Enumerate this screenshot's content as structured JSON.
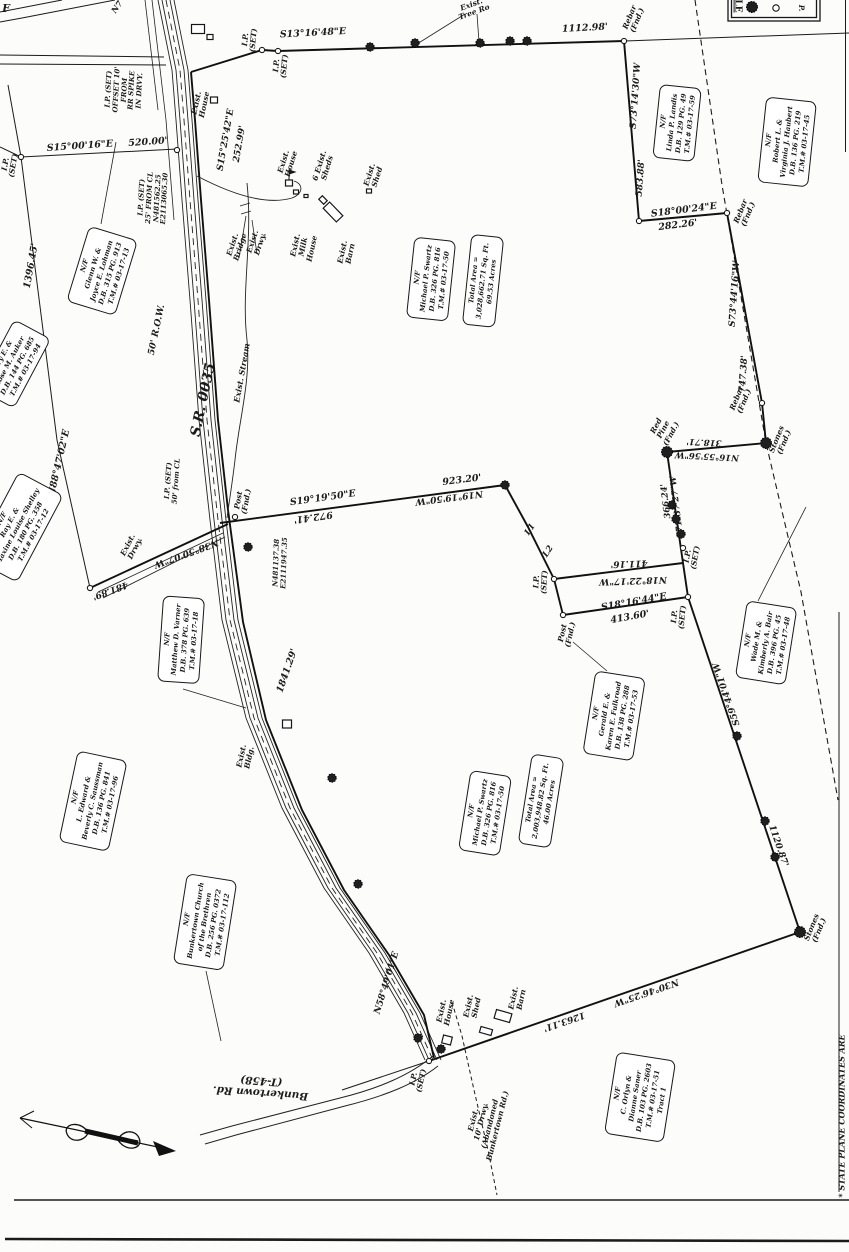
{
  "drawing": {
    "type": "land survey plat",
    "ink_color": "#1b1b1b",
    "paper_color": "#fcfcfa"
  },
  "legend": {
    "title_partial": "LE",
    "symbols": [
      "tree-symbol",
      "monument-circle",
      "pin-letter"
    ]
  },
  "labels": [
    {
      "id": "f_partial",
      "lines": [
        "F"
      ]
    },
    {
      "id": "n7_partial",
      "lines": [
        "N7"
      ]
    },
    {
      "id": "treerow",
      "lines": [
        "Exist.",
        "Tree Ro"
      ]
    },
    {
      "id": "b_s13",
      "lines": [
        "S13°16'48\"E"
      ]
    },
    {
      "id": "d_1112",
      "lines": [
        "1112.98'"
      ]
    },
    {
      "id": "rebar_top",
      "lines": [
        "Rebar",
        "(Fnd.)"
      ]
    },
    {
      "id": "b_s73_14",
      "lines": [
        "S73°14'30\"W"
      ]
    },
    {
      "id": "d_583",
      "lines": [
        "583.88'"
      ]
    },
    {
      "id": "b_s18_00",
      "lines": [
        "S18°00'24\"E"
      ]
    },
    {
      "id": "d_282",
      "lines": [
        "282.26'"
      ]
    },
    {
      "id": "rebar_2",
      "lines": [
        "Rebar",
        "(Fnd.)"
      ]
    },
    {
      "id": "b_s73_44",
      "lines": [
        "S73°44'16\"W"
      ]
    },
    {
      "id": "d_747",
      "lines": [
        "747.38'"
      ]
    },
    {
      "id": "rebar_3",
      "lines": [
        "Rebar",
        "(Fnd.)"
      ]
    },
    {
      "id": "stones_1",
      "lines": [
        "Stones",
        "(Fnd.)"
      ]
    },
    {
      "id": "redpine",
      "lines": [
        "Red",
        "Pine",
        "(Fnd.)"
      ]
    },
    {
      "id": "b_n16",
      "lines": [
        "N16°55'56\"W"
      ]
    },
    {
      "id": "d_318",
      "lines": [
        "318.71'"
      ]
    },
    {
      "id": "b_s71",
      "lines": [
        "S71°37'27\"W"
      ]
    },
    {
      "id": "d_366",
      "lines": [
        "366.24'"
      ]
    },
    {
      "id": "ip_set_r",
      "lines": [
        "I.P.",
        "(SET)"
      ]
    },
    {
      "id": "b_s19",
      "lines": [
        "S19°19'50\"E"
      ]
    },
    {
      "id": "d_972",
      "lines": [
        "972.41'"
      ]
    },
    {
      "id": "d_923",
      "lines": [
        "923.20'"
      ]
    },
    {
      "id": "b_n19",
      "lines": [
        "N19°19'50\"W"
      ]
    },
    {
      "id": "l1",
      "lines": [
        "L1"
      ]
    },
    {
      "id": "l2",
      "lines": [
        "L2"
      ]
    },
    {
      "id": "ip_set_c1",
      "lines": [
        "I.P.",
        "(SET)"
      ]
    },
    {
      "id": "d_411",
      "lines": [
        "411.16'"
      ]
    },
    {
      "id": "b_n18",
      "lines": [
        "N18°22'17\"W"
      ]
    },
    {
      "id": "b_s18_16",
      "lines": [
        "S18°16'44\"E"
      ]
    },
    {
      "id": "d_413",
      "lines": [
        "413.60'"
      ]
    },
    {
      "id": "post_fnd_c",
      "lines": [
        "Post",
        "(Fnd.)"
      ]
    },
    {
      "id": "ip_set_c2",
      "lines": [
        "I.P.",
        "(SET)"
      ]
    },
    {
      "id": "b_s59",
      "lines": [
        "S59°44'01\"W"
      ]
    },
    {
      "id": "d_1120",
      "lines": [
        "1120.87'"
      ]
    },
    {
      "id": "stones_2",
      "lines": [
        "Stones",
        "(Fnd.)"
      ]
    },
    {
      "id": "b_n30",
      "lines": [
        "N30°46'25\"W"
      ]
    },
    {
      "id": "d_1263",
      "lines": [
        "1263.11'"
      ]
    },
    {
      "id": "b_n58",
      "lines": [
        "N58°49'01\"E"
      ]
    },
    {
      "id": "ip_set_b",
      "lines": [
        "I.P.",
        "(SET)"
      ]
    },
    {
      "id": "d_1841",
      "lines": [
        "1841.29'"
      ]
    },
    {
      "id": "b_n38",
      "lines": [
        "N38°50'07\"W"
      ]
    },
    {
      "id": "d_481",
      "lines": [
        "481.89'"
      ]
    },
    {
      "id": "ip_set_l",
      "lines": [
        "I.P.",
        "(SET)"
      ]
    },
    {
      "id": "b_s15_00",
      "lines": [
        "S15°00'16\"E"
      ]
    },
    {
      "id": "d_520",
      "lines": [
        "520.00'"
      ]
    },
    {
      "id": "ip_block_offset",
      "lines": [
        "I.P. (SET)",
        "OFFSET 10'",
        "FROM",
        "RR SPIKE",
        "IN DRVY."
      ]
    },
    {
      "id": "ip_block_25",
      "lines": [
        "I.P. (SET)",
        "25' FROM CL",
        "N481562.25",
        "E2113065.30"
      ]
    },
    {
      "id": "b_s15_25",
      "lines": [
        "S15°25'42\"E"
      ]
    },
    {
      "id": "d_252",
      "lines": [
        "252.99'"
      ]
    },
    {
      "id": "ip_set_t1",
      "lines": [
        "I.P.",
        "(SET)"
      ]
    },
    {
      "id": "ip_set_t2",
      "lines": [
        "I.P.",
        "(SET)"
      ]
    },
    {
      "id": "d_1396",
      "lines": [
        "1396.45'"
      ]
    },
    {
      "id": "b_n88",
      "lines": [
        "N88°47'02\"E"
      ]
    },
    {
      "id": "sr0035",
      "lines": [
        "S.R. 0035"
      ]
    },
    {
      "id": "row50",
      "lines": [
        "50' R.O.W."
      ]
    },
    {
      "id": "stream_lbl",
      "lines": [
        "Exist. Stream"
      ]
    },
    {
      "id": "drwy_top",
      "lines": [
        "Exist.",
        "Drwy."
      ]
    },
    {
      "id": "bridge",
      "lines": [
        "Exist.",
        "Bridge"
      ]
    },
    {
      "id": "milk",
      "lines": [
        "Exist.",
        "Milk",
        "House"
      ]
    },
    {
      "id": "barn_top",
      "lines": [
        "Exist.",
        "Barn"
      ]
    },
    {
      "id": "house_top1",
      "lines": [
        "Exist.",
        "House"
      ]
    },
    {
      "id": "house_top2",
      "lines": [
        "Exist.",
        "House"
      ]
    },
    {
      "id": "sheds6",
      "lines": [
        "6 Exist.",
        "Sheds"
      ]
    },
    {
      "id": "shed_top",
      "lines": [
        "Exist.",
        "Shed"
      ]
    },
    {
      "id": "ip_50cl",
      "lines": [
        "I.P. (SET)",
        "50' from CL"
      ]
    },
    {
      "id": "post_fnd_r",
      "lines": [
        "Post",
        "(Fnd.)"
      ]
    },
    {
      "id": "coords2",
      "lines": [
        "N481137.38",
        "E2111947.35"
      ]
    },
    {
      "id": "bldg",
      "lines": [
        "Exist.",
        "Bldg."
      ]
    },
    {
      "id": "drwy_left",
      "lines": [
        "Exist.",
        "Drwy."
      ]
    },
    {
      "id": "house_b",
      "lines": [
        "Exist.",
        "House"
      ]
    },
    {
      "id": "shed_b",
      "lines": [
        "Exist.",
        "Shed"
      ]
    },
    {
      "id": "barn_b",
      "lines": [
        "Exist.",
        "Barn"
      ]
    },
    {
      "id": "drwy_abandoned",
      "lines": [
        "Exist.",
        "10' Drwy.",
        "(Abandoned",
        "Bunkertown Rd.)"
      ]
    },
    {
      "id": "bunkertown",
      "lines": [
        "Bunkertown Rd.",
        "(T-458)"
      ]
    },
    {
      "id": "stateplane",
      "lines": [
        "* STATE PLANE COORDINATES ARE"
      ]
    },
    {
      "id": "legend_p",
      "lines": [
        "P."
      ]
    }
  ],
  "parcel_boxes": [
    {
      "id": "lohman",
      "lines": [
        "N/F",
        "Glenn W. &",
        "Joyce E. Lohman",
        "D.B. 315  PG. 913",
        "T.M.# 03-17-13"
      ]
    },
    {
      "id": "auker",
      "lines": [
        "Jerry E. &",
        "Rose M. Auker",
        "D.B. 144  PG. 685",
        "T.M.# 03-17-94"
      ]
    },
    {
      "id": "shelley",
      "lines": [
        "N/F",
        "Ray E. &",
        "Maxine Louise Shelley",
        "D.B. 180  PG. 358",
        "T.M.# 03-17-12"
      ]
    },
    {
      "id": "swartz1",
      "lines": [
        "N/F",
        "Michael P. Swartz",
        "D.B. 326  PG. 816",
        "T.M.# 03-17-50"
      ]
    },
    {
      "id": "area1",
      "lines": [
        "Total Area =",
        "3,028,662.71 Sq. Ft.",
        "69.53 Acres"
      ]
    },
    {
      "id": "landis",
      "lines": [
        "N/F",
        "Linda P. Landis",
        "D.B. 129  PG. 49",
        "T.M.# 03-17-59"
      ]
    },
    {
      "id": "haubert",
      "lines": [
        "N/F",
        "Robert L. &",
        "Virginia J. Haubert",
        "D.B. 136  PG. 219",
        "T.M.# 03-17-45"
      ]
    },
    {
      "id": "varner",
      "lines": [
        "N/F",
        "Matthew D. Varner",
        "D.B. 378  PG. 639",
        "T.M.# 03-17-18"
      ]
    },
    {
      "id": "saussman",
      "lines": [
        "N/F",
        "L. Edward &",
        "Beverly C. Saussman",
        "D.B. 136  PG. 841",
        "T.M.# 03-17-96"
      ]
    },
    {
      "id": "church",
      "lines": [
        "N/F",
        "Bunkertown Church",
        "of the Brethren",
        "D.B. 256  PG. 0372",
        "T.M.# 03-17-112"
      ]
    },
    {
      "id": "swartz2",
      "lines": [
        "N/F",
        "Michael P. Swartz",
        "D.B. 326  PG. 816",
        "T.M.# 03-17-50"
      ]
    },
    {
      "id": "area2",
      "lines": [
        "Total Area =",
        "2,003,948.82 Sq. Ft.",
        "46.00 Acres"
      ]
    },
    {
      "id": "fulkroad",
      "lines": [
        "N/F",
        "Gerald E. &",
        "Karen E. Fulkroad",
        "D.B. 138  PG. 288",
        "T.M.# 03-17-53"
      ]
    },
    {
      "id": "bair",
      "lines": [
        "N/F",
        "Wade M. &",
        "Kimberly A. Bair",
        "D.B. 396  PG. 45",
        "T.M.# 03-17-48"
      ]
    },
    {
      "id": "saner",
      "lines": [
        "N/F",
        "C. Orlyn &",
        "Dianne Saner",
        "D.B. 103  PG. 2603",
        "T.M.# 03-17-51",
        "Tract 1"
      ]
    }
  ]
}
